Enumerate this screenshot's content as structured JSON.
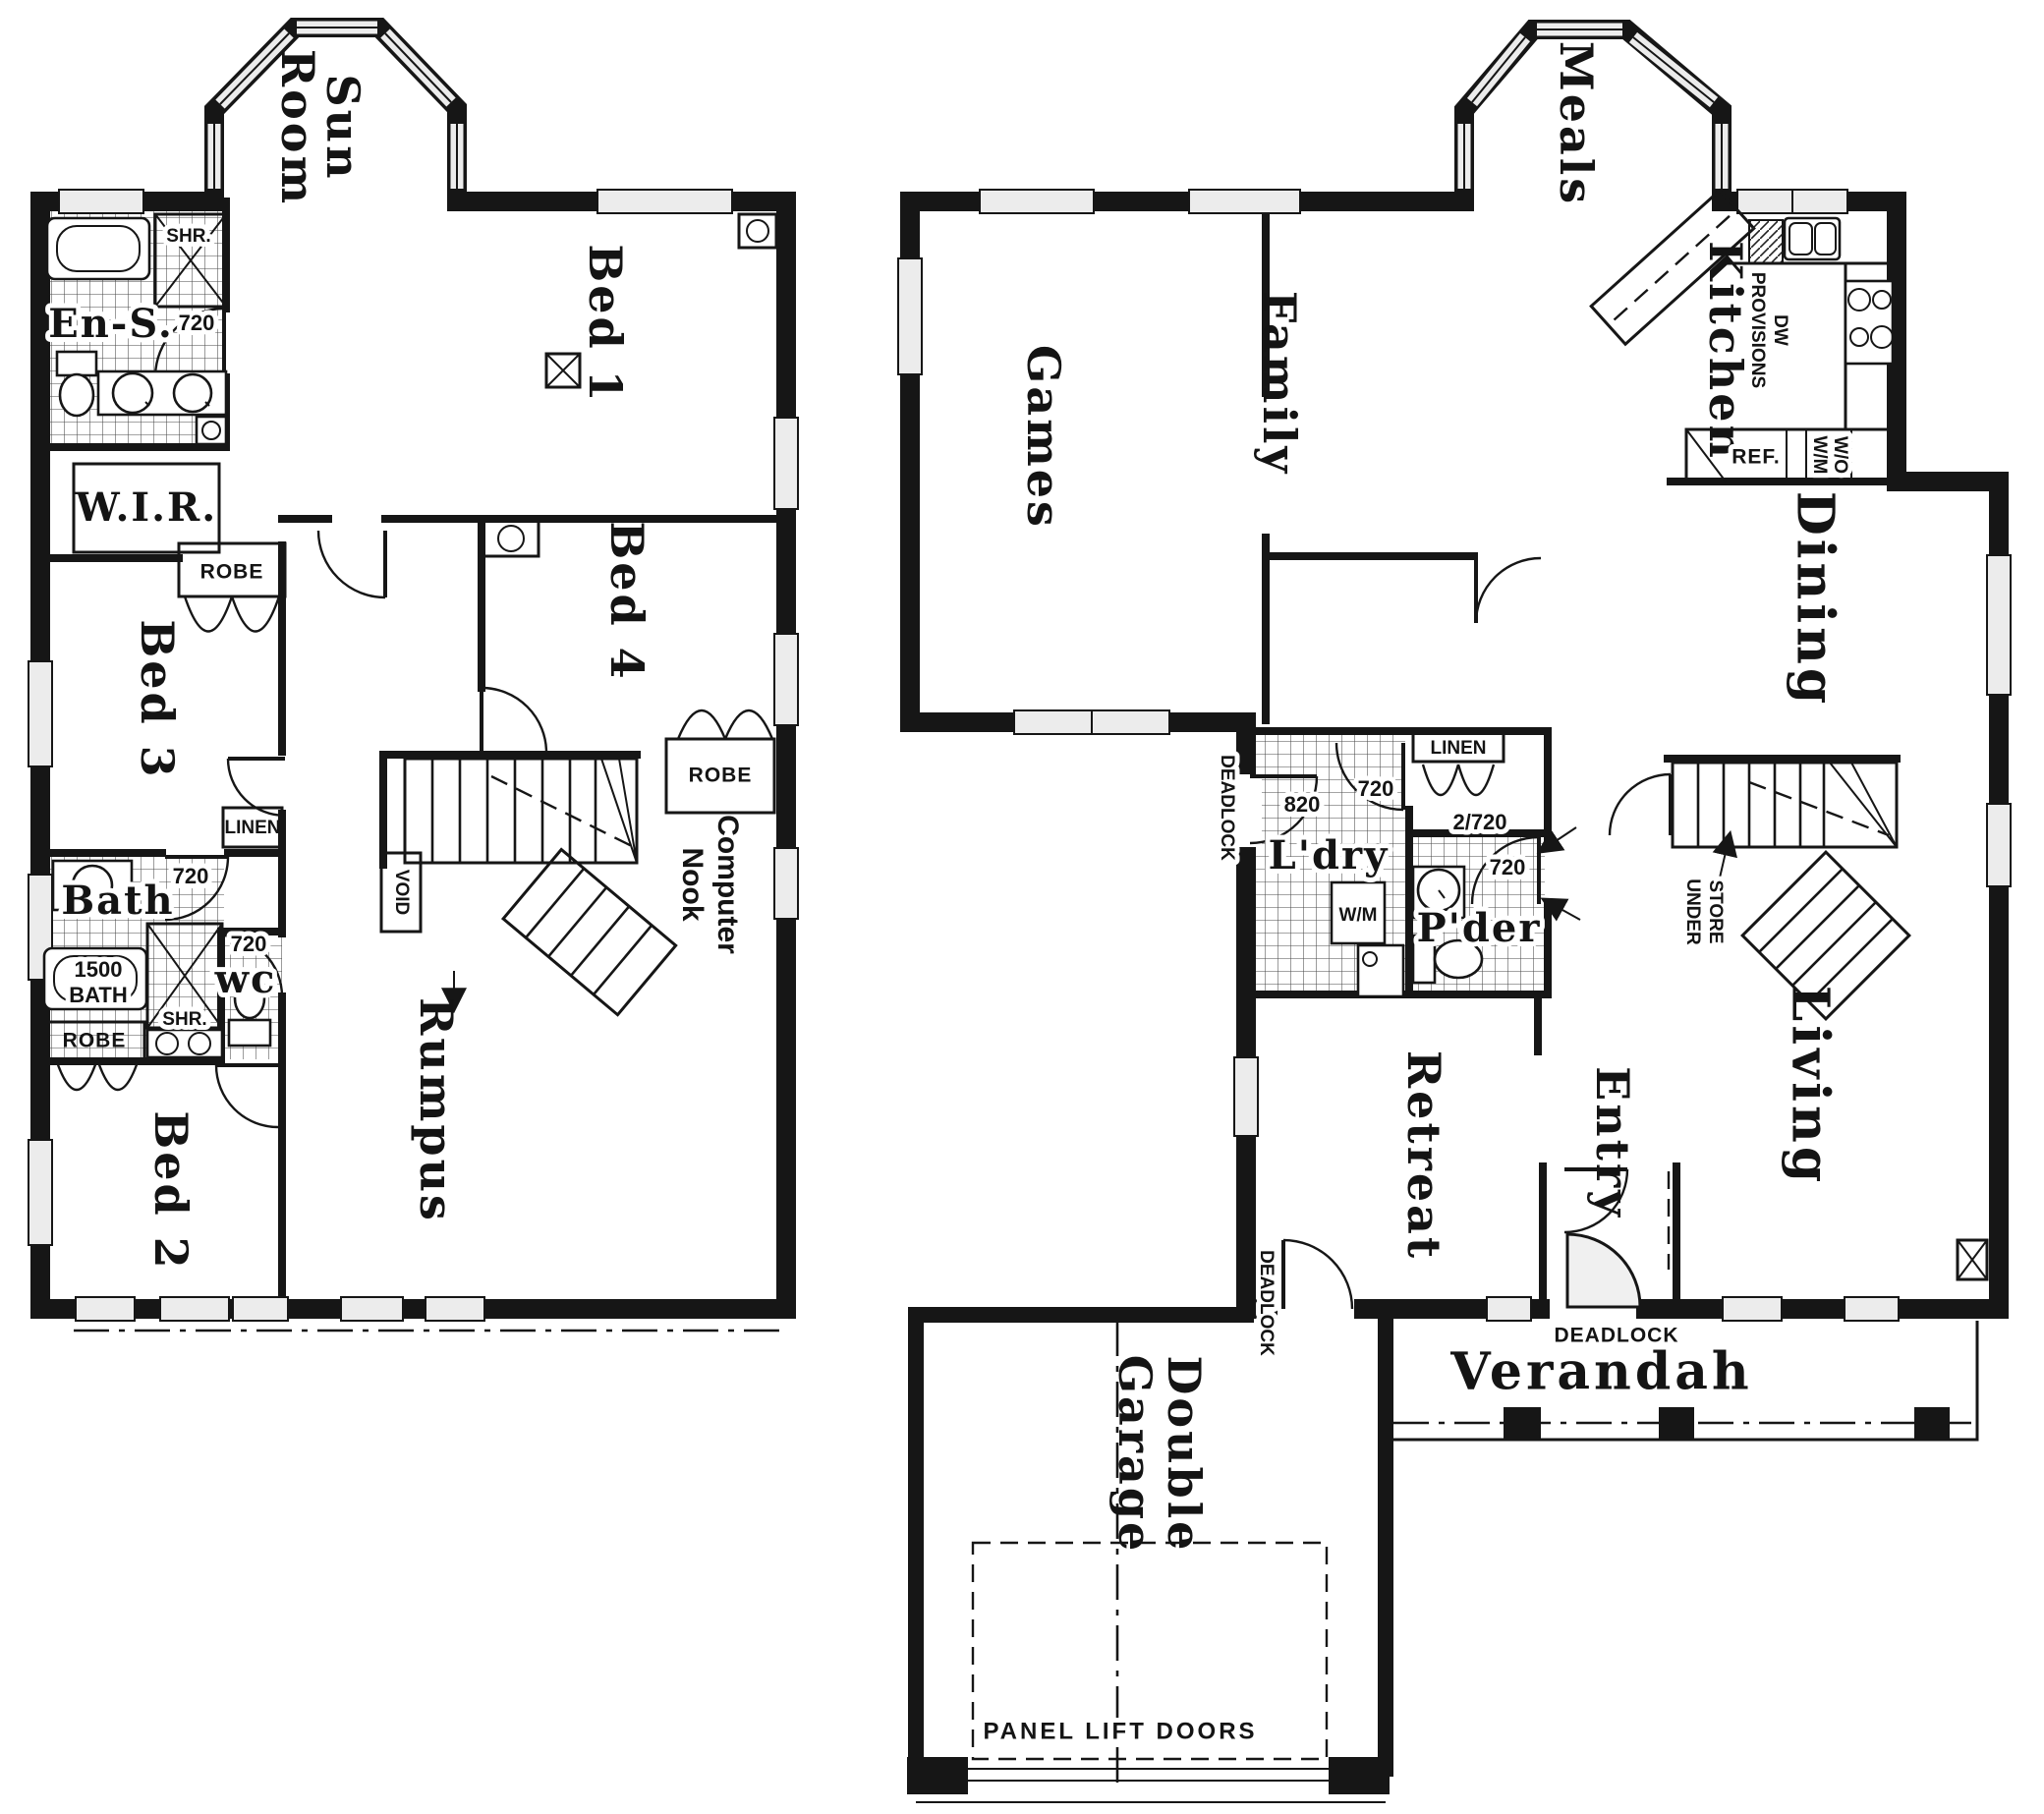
{
  "meta": {
    "drawing_type": "two storey house floor plans",
    "ink_color": "#161616",
    "paper_color": "#ffffff"
  },
  "upper_floor": {
    "rooms": {
      "sun_room": [
        "Sun",
        "Room"
      ],
      "bed_1": "Bed 1",
      "ensuite": "En-S.",
      "walk_in_robe": "W.I.R.",
      "bed_3": "Bed 3",
      "bed_4": "Bed 4",
      "bath": "Bath",
      "wc": "wc",
      "bed_2": "Bed 2",
      "rumpus": "Rumpus",
      "computer_nook": [
        "Computer",
        "Nook"
      ],
      "void": "VOID"
    },
    "closets": {
      "robe_hall": "ROBE",
      "robe_bed_2": "ROBE",
      "robe_nook": "ROBE",
      "linen": "LINEN"
    },
    "fixtures": {
      "tub": [
        "1500",
        "BATH"
      ],
      "shower_ensuite": "SHR.",
      "shower_bath": "SHR."
    },
    "door_widths": {
      "ensuite": "720",
      "bath": "720",
      "wc": "720"
    }
  },
  "ground_floor": {
    "rooms": {
      "meals": "Meals",
      "games": "Games",
      "family": "Family",
      "kitchen": "Kitchen",
      "dining": "Dining",
      "laundry": "L'dry",
      "powder": "P'der",
      "living": "Living",
      "retreat": "Retreat",
      "entry": "Entry",
      "verandah": "Verandah",
      "double_garage": [
        "Double",
        "Garage"
      ]
    },
    "closets": {
      "linen": "LINEN"
    },
    "appliances": {
      "dishwasher": [
        "DW",
        "PROVISIONS"
      ],
      "fridge": "REF.",
      "oven_microwave": [
        "W/O",
        "W/M"
      ],
      "washing_machine": "W/M"
    },
    "stairs": {
      "store_under": [
        "STORE",
        "UNDER"
      ]
    },
    "door_widths": {
      "laundry_external": "820",
      "laundry_internal": "720",
      "linen": "2/720",
      "powder": "720"
    },
    "locks": {
      "laundry_door": "DEADLOCK",
      "rear_door": "DEADLOCK",
      "front_door": "DEADLOCK"
    },
    "garage": {
      "door_note": "PANEL LIFT DOORS"
    }
  }
}
